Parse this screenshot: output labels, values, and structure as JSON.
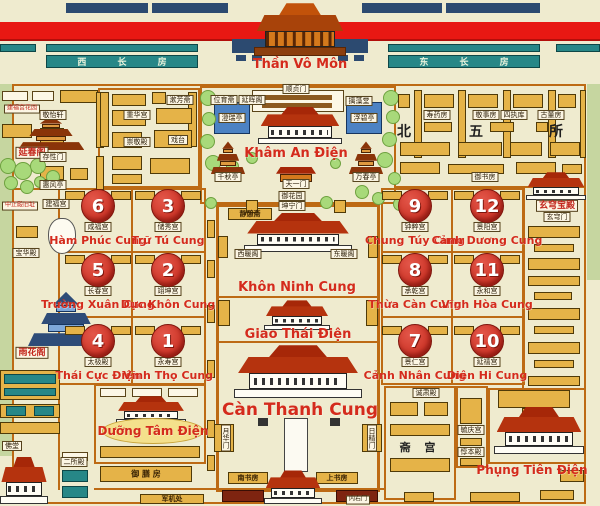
{
  "top": {
    "west_rooms": "西 长 房",
    "east_rooms": "东 长 房",
    "gate_name": "Thần Vô Môn"
  },
  "garden": {
    "title": "Khâm An Điện",
    "gate_north": "顺贞门",
    "weiyu": "位育斋",
    "yanhui": "延晖阁",
    "chizao": "摛藻堂",
    "chengrui": "澄瑞亭",
    "fubi": "浮碧亭",
    "qianqiu": "千秋亭",
    "wanchun": "万春亭",
    "tianyi": "天一门",
    "yuhuayuan": "御花园"
  },
  "axis": {
    "kunning_gate": "坤宁门",
    "jingqizhai": "静憩斋",
    "xinuange": "西暖阁",
    "dongnuange": "东暖阁",
    "kunning": "Khôn Ninh Cung",
    "jiaotai": "Giao Thái Điện",
    "qianqing": "Càn Thanh Cung",
    "yuehua": "月华门",
    "rijing": "日精门",
    "nanshufang": "南书房",
    "shangshufang": "上书房",
    "neiyou": "内右门"
  },
  "west_palaces": [
    {
      "num": "6",
      "vn": "Hàm Phúc Cung",
      "cn": "咸福宫"
    },
    {
      "num": "3",
      "vn": "Trữ Tú Cung",
      "cn": "储秀宫"
    },
    {
      "num": "5",
      "vn": "Trường Xuân Cung",
      "cn": "长春宫"
    },
    {
      "num": "2",
      "vn": "Dực Khôn Cung",
      "cn": "翊坤宫"
    },
    {
      "num": "4",
      "vn": "Thái Cực Điện",
      "cn": "太极殿"
    },
    {
      "num": "1",
      "vn": "Vĩnh Thọ Cung",
      "cn": "永寿宫"
    }
  ],
  "east_palaces": [
    {
      "num": "9",
      "vn": "Chung Túy Cung",
      "cn": "钟粹宫"
    },
    {
      "num": "12",
      "vn": "Cảnh Dương Cung",
      "cn": "景阳宫"
    },
    {
      "num": "8",
      "vn": "Thừa Càn Cung",
      "cn": "承乾宫"
    },
    {
      "num": "11",
      "vn": "Vĩnh Hòa Cung",
      "cn": "永和宫"
    },
    {
      "num": "7",
      "vn": "Cảnh Nhân Cung",
      "cn": "景仁宫"
    },
    {
      "num": "10",
      "vn": "Diên Hi Cung",
      "cn": "延禧宫"
    }
  ],
  "north_five": {
    "chars": [
      "北",
      "五",
      "所"
    ],
    "rooms": [
      "寿药房",
      "敬事房",
      "四执库",
      "古董房"
    ],
    "yushufang": "御书房"
  },
  "east_side": {
    "xuanqiong": "玄穹宝殿",
    "xuanqiongmen": "玄穹门"
  },
  "west_side": {
    "yanchunge": "延春阁",
    "jianfu_garden": "建福宫花园",
    "jingyixuan": "敬怡轩",
    "cunxingmen": "存性门",
    "huifengting": "惠风亭",
    "jianfugong": "建福宫",
    "zhongzheng": "中正殿旧址",
    "baohuadian": "宝华殿",
    "yuhuage": "雨花阁",
    "chonghuagong": "重华宫",
    "chongjingdian": "崇敬殿",
    "shufangzhai": "漱芳斋",
    "xitai": "戏台"
  },
  "south_west": {
    "yangxin": "Dưỡng Tâm Điện",
    "fotang": "佛堂",
    "ersuodian": "二所殿",
    "yushanfang": "御 膳 房",
    "junjichu": "军机处"
  },
  "south_east": {
    "fengxian": "Phụng Tiên Điện",
    "chengsudian": "诚肃殿",
    "zhaigong": "斋 宫",
    "yuqinggong": "毓庆宫",
    "dunbendian": "惇本殿"
  },
  "colors": {
    "accent_red": "#D42B1C",
    "circle_red": "#CE3425",
    "gold": "#E5B348",
    "teal": "#278787",
    "navy": "#2C4A70",
    "wall_orange": "#BD6A14"
  }
}
